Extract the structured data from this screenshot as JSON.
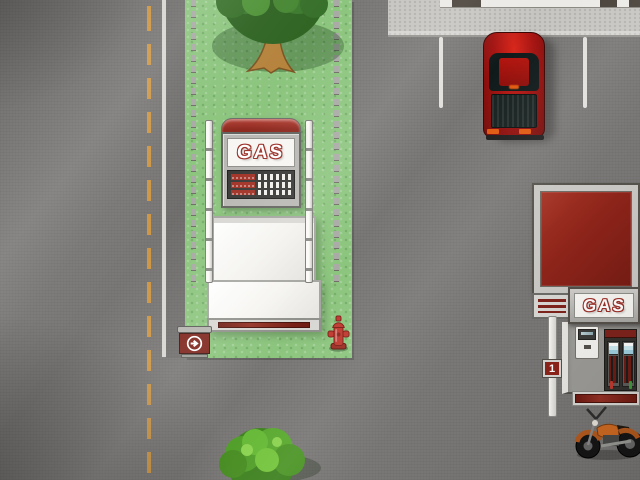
{
  "scene": {
    "view": "top-down",
    "setting": "street with gas station, parked vehicles and grass median"
  },
  "signs": {
    "roadside_gas": {
      "label": "GAS"
    },
    "storefront_gas": {
      "label": "GAS"
    },
    "pump_number": {
      "label": "1"
    }
  },
  "icons": {
    "direction_sign": "right-arrow-in-circle-icon",
    "price_board": "fuel-price-rows",
    "digit_grid": "price-digit-grid"
  },
  "objects": {
    "vehicles": [
      "red pickup truck",
      "orange motorcycle"
    ],
    "props": [
      "roadside gas pylon sign",
      "gas pump canopy kiosk",
      "direction arrow sign",
      "fire hydrant",
      "vending machine",
      "twin fuel pumps",
      "walkway mat",
      "pump number pole",
      "tree",
      "bush",
      "post fences"
    ]
  },
  "colors": {
    "road": "#7a7876",
    "grass": "#8cc57e",
    "sidewalk": "#c7c5c1",
    "lane_line_yellow": "#d79a40",
    "edge_line_white": "#e9e7e3",
    "sign_red": "#8e241a",
    "frame_gray": "#b9b8b4",
    "panel_white": "#f7f6f2",
    "display_black": "#383836",
    "truck_red": "#a31210",
    "hydrant_red": "#c0392f",
    "motorcycle_orange": "#d06a22",
    "tree_green": "#3c7c2a",
    "bush_green": "#57a82c",
    "pump_screen_blue": "#cdeaf2",
    "nozzle_green": "#3f9a3a",
    "nozzle_red": "#c0392f"
  }
}
